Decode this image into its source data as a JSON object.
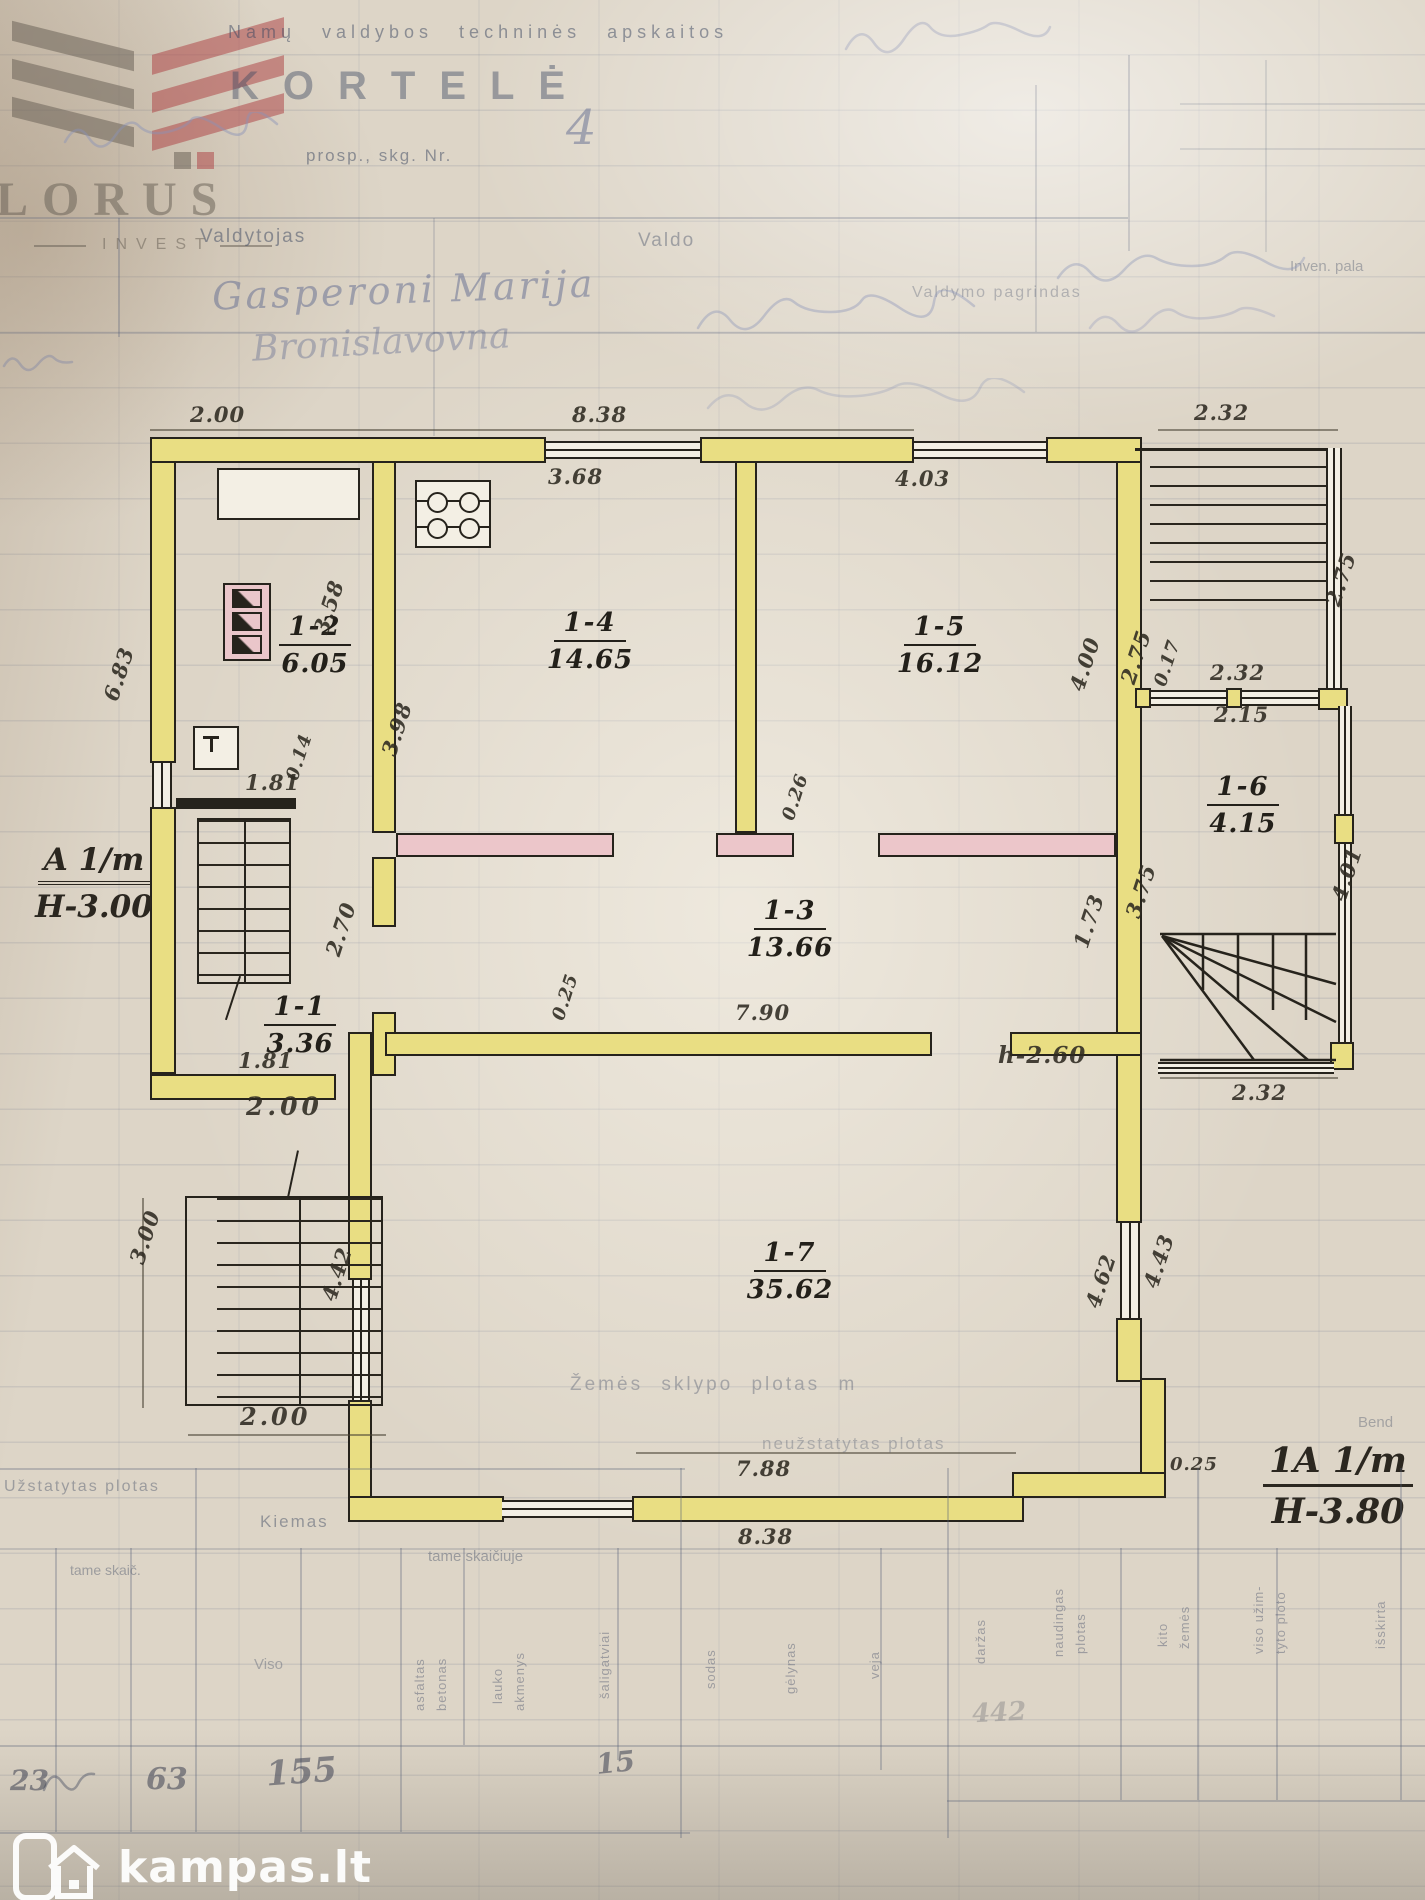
{
  "watermark": {
    "brand": "LORUS",
    "sub": "INVEST"
  },
  "header": {
    "dept": "Namų valdybos techninės apskaitos",
    "title": "KORTELĖ",
    "address": "prosp., skg. Nr.",
    "address_no": "4",
    "col1": "Valdytojas",
    "col2": "Valdo",
    "col3": "Valdymo pagrindas",
    "col4": "Inven. pala",
    "name": "Gasperoni Marija",
    "name2": "Bronislavovna"
  },
  "plan": {
    "rooms": [
      {
        "id": "1-1",
        "area": "3.36"
      },
      {
        "id": "1-2",
        "area": "6.05"
      },
      {
        "id": "1-3",
        "area": "13.66"
      },
      {
        "id": "1-4",
        "area": "14.65"
      },
      {
        "id": "1-5",
        "area": "16.12"
      },
      {
        "id": "1-6",
        "area": "4.15"
      },
      {
        "id": "1-7",
        "area": "35.62"
      }
    ],
    "dims": [
      "2.00",
      "8.38",
      "2.32",
      "3.68",
      "4.03",
      "2.75",
      "3.58",
      "3.98",
      "4.00",
      "2.75",
      "0.17",
      "2.32",
      "2.15",
      "6.83",
      "1.81",
      "0.14",
      "2.70",
      "0.26",
      "3.75",
      "1.73",
      "4.01",
      "0.25",
      "7.90",
      "2.32",
      "4.62",
      "4.43",
      "1.81",
      "2.00",
      "3.00",
      "4.42",
      "2.00",
      "7.88",
      "8.38",
      "0.25"
    ],
    "ann": {
      "a_mark": "A 1/m",
      "a_h": "H-3.00",
      "b_mark": "1A 1/m",
      "b_h": "H-3.80",
      "door_h": "h-2.60"
    }
  },
  "land": {
    "plot": "Žemės sklypo plotas m",
    "unbuilt": "neužstatytas plotas",
    "built": "Užstatytas plotas",
    "yard": "Kiemas",
    "tame1": "tame skaič.",
    "tame2": "tame skaičiuje",
    "viso": "Viso",
    "bend": "Bend",
    "cols": [
      "asfaltas",
      "betonas",
      "lauko",
      "akmenys",
      "šaligatviai",
      "sodas",
      "gėlynas",
      "veja",
      "daržas",
      "naudingas",
      "plotas",
      "kito",
      "žemės",
      "viso užim-",
      "tyto ploto",
      "išskirta"
    ],
    "vals": [
      "23",
      "63",
      "155",
      "15",
      "442"
    ]
  },
  "logo": {
    "text": "kampas.lt"
  }
}
